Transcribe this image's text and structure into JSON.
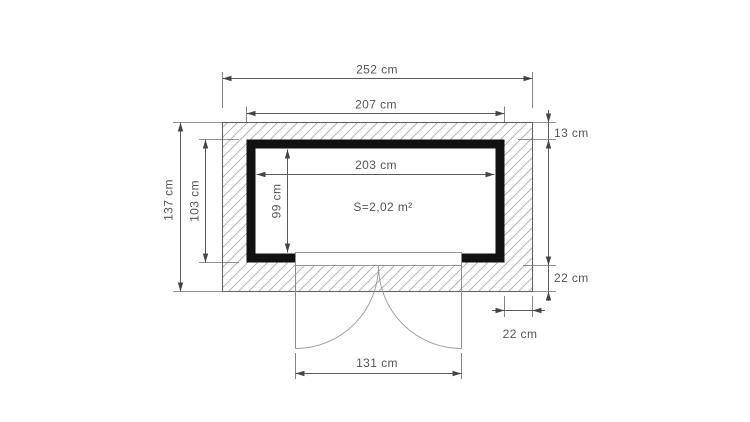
{
  "figure": {
    "area_label": "S=2,02 m²",
    "dimensions": {
      "total_width": "252 cm",
      "wall_outer_width": "207 cm",
      "inner_width": "203 cm",
      "total_depth": "137 cm",
      "wall_outer_depth": "103 cm",
      "inner_depth": "99 cm",
      "top_overhang": "13 cm",
      "side_overhang": "22 cm",
      "corner_overhang": "22 cm",
      "door_width": "131 cm"
    },
    "colors": {
      "background": "#ffffff",
      "wall": "#121212",
      "dimension_line": "#5a5a5a",
      "hatch": "#ababab",
      "label_text": "#555555"
    }
  }
}
